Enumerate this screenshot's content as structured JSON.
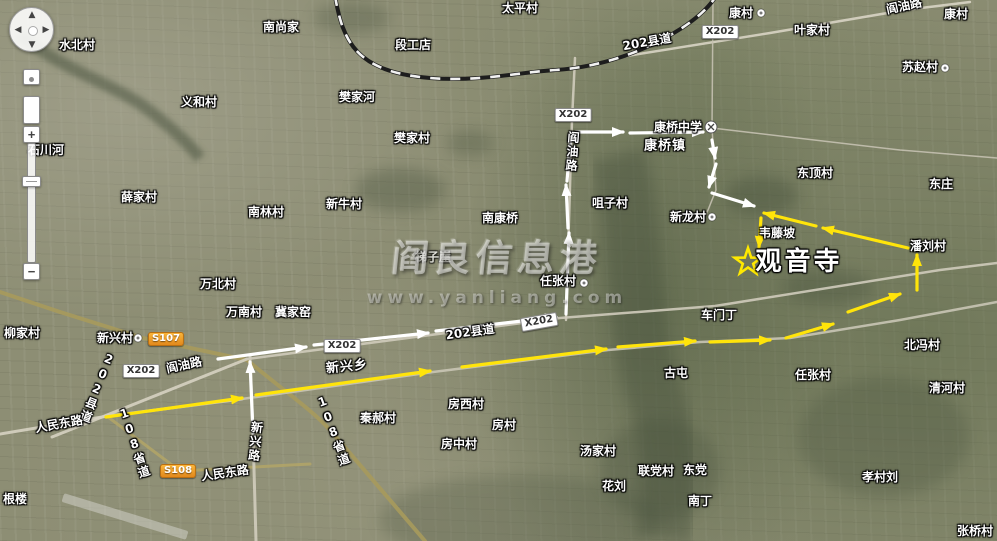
{
  "map": {
    "watermark": {
      "line1": "阎良信息港",
      "line2": "www.yanliang.com"
    },
    "destination": {
      "name": "观音寺",
      "star_x": 748,
      "star_y": 262
    },
    "colors": {
      "route_yellow": "#ffe40a",
      "route_white": "#ffffff",
      "star": "#ffe900",
      "shield": "#f2a124",
      "road_tan": "#a79a5c",
      "road_gray": "#d4d0c0",
      "veg": "#44503a"
    },
    "labels": [
      {
        "t": "水北村",
        "x": 77,
        "y": 45,
        "ty": "v"
      },
      {
        "t": "南尚家",
        "x": 281,
        "y": 27,
        "ty": "v"
      },
      {
        "t": "太平村",
        "x": 520,
        "y": 8,
        "ty": "v"
      },
      {
        "t": "段工店",
        "x": 413,
        "y": 45,
        "ty": "v"
      },
      {
        "t": "康村",
        "x": 741,
        "y": 13,
        "ty": "v"
      },
      {
        "t": "阎油路",
        "x": 904,
        "y": 6,
        "ty": "r",
        "rot": -12
      },
      {
        "t": "康村",
        "x": 956,
        "y": 14,
        "ty": "v"
      },
      {
        "t": "叶家村",
        "x": 812,
        "y": 30,
        "ty": "v"
      },
      {
        "t": "X202",
        "x": 720,
        "y": 32,
        "ty": "b"
      },
      {
        "t": "202县道",
        "x": 647,
        "y": 42,
        "ty": "r",
        "rot": -10
      },
      {
        "t": "苏赵村",
        "x": 920,
        "y": 67,
        "ty": "v"
      },
      {
        "t": "义和村",
        "x": 199,
        "y": 102,
        "ty": "v"
      },
      {
        "t": "樊家河",
        "x": 357,
        "y": 97,
        "ty": "v"
      },
      {
        "t": "X202",
        "x": 573,
        "y": 115,
        "ty": "b"
      },
      {
        "t": "樊家村",
        "x": 412,
        "y": 138,
        "ty": "v"
      },
      {
        "t": "康桥中学",
        "x": 678,
        "y": 127,
        "ty": "v"
      },
      {
        "t": "康桥镇",
        "x": 665,
        "y": 146,
        "ty": "t"
      },
      {
        "t": "阎油路",
        "x": 572,
        "y": 152,
        "ty": "vert",
        "rot": 4
      },
      {
        "t": "东顶村",
        "x": 815,
        "y": 173,
        "ty": "v"
      },
      {
        "t": "东庄",
        "x": 941,
        "y": 184,
        "ty": "v"
      },
      {
        "t": "石川河",
        "x": 46,
        "y": 150,
        "ty": "v"
      },
      {
        "t": "薛家村",
        "x": 139,
        "y": 197,
        "ty": "v"
      },
      {
        "t": "南林村",
        "x": 266,
        "y": 212,
        "ty": "v"
      },
      {
        "t": "新牛村",
        "x": 344,
        "y": 204,
        "ty": "v"
      },
      {
        "t": "咀子村",
        "x": 610,
        "y": 203,
        "ty": "v"
      },
      {
        "t": "南康桥",
        "x": 500,
        "y": 218,
        "ty": "v"
      },
      {
        "t": "新龙村",
        "x": 688,
        "y": 217,
        "ty": "v"
      },
      {
        "t": "韦藤坡",
        "x": 777,
        "y": 233,
        "ty": "v"
      },
      {
        "t": "潘刘村",
        "x": 928,
        "y": 246,
        "ty": "v"
      },
      {
        "t": "梯子崖",
        "x": 433,
        "y": 257,
        "ty": "v",
        "faint": true
      },
      {
        "t": "任张村",
        "x": 558,
        "y": 281,
        "ty": "v"
      },
      {
        "t": "观音寺",
        "x": 799,
        "y": 262,
        "ty": "big"
      },
      {
        "t": "万北村",
        "x": 218,
        "y": 284,
        "ty": "v"
      },
      {
        "t": "万南村",
        "x": 244,
        "y": 312,
        "ty": "v"
      },
      {
        "t": "冀家窑",
        "x": 293,
        "y": 312,
        "ty": "v"
      },
      {
        "t": "车门丁",
        "x": 719,
        "y": 315,
        "ty": "v"
      },
      {
        "t": "柳家村",
        "x": 22,
        "y": 333,
        "ty": "v"
      },
      {
        "t": "新兴村",
        "x": 115,
        "y": 338,
        "ty": "v"
      },
      {
        "t": "S107",
        "x": 166,
        "y": 339,
        "ty": "s"
      },
      {
        "t": "阎油路",
        "x": 184,
        "y": 365,
        "ty": "r",
        "rot": -12
      },
      {
        "t": "X202",
        "x": 141,
        "y": 371,
        "ty": "b"
      },
      {
        "t": "202县道",
        "x": 97,
        "y": 388,
        "ty": "vert",
        "rot": 22
      },
      {
        "t": "新兴乡",
        "x": 347,
        "y": 367,
        "ty": "t",
        "rot": -6
      },
      {
        "t": "X202",
        "x": 342,
        "y": 346,
        "ty": "b"
      },
      {
        "t": "202县道",
        "x": 470,
        "y": 332,
        "ty": "r",
        "rot": -8
      },
      {
        "t": "X202",
        "x": 539,
        "y": 322,
        "ty": "b",
        "rot": -10
      },
      {
        "t": "北冯村",
        "x": 922,
        "y": 345,
        "ty": "v"
      },
      {
        "t": "任张村",
        "x": 813,
        "y": 375,
        "ty": "v"
      },
      {
        "t": "古屯",
        "x": 676,
        "y": 373,
        "ty": "v"
      },
      {
        "t": "清河村",
        "x": 947,
        "y": 388,
        "ty": "v"
      },
      {
        "t": "人民东路",
        "x": 59,
        "y": 424,
        "ty": "r",
        "rot": -10
      },
      {
        "t": "108省道",
        "x": 134,
        "y": 443,
        "ty": "vert",
        "rot": -18
      },
      {
        "t": "秦郝村",
        "x": 378,
        "y": 418,
        "ty": "v"
      },
      {
        "t": "房西村",
        "x": 466,
        "y": 404,
        "ty": "v"
      },
      {
        "t": "房村",
        "x": 504,
        "y": 425,
        "ty": "v"
      },
      {
        "t": "房中村",
        "x": 459,
        "y": 444,
        "ty": "v"
      },
      {
        "t": "汤家村",
        "x": 598,
        "y": 451,
        "ty": "v"
      },
      {
        "t": "108省道",
        "x": 333,
        "y": 431,
        "ty": "vert",
        "rot": -20
      },
      {
        "t": "新兴路",
        "x": 255,
        "y": 442,
        "ty": "vert",
        "rot": 6
      },
      {
        "t": "S108",
        "x": 178,
        "y": 471,
        "ty": "s"
      },
      {
        "t": "人民东路",
        "x": 225,
        "y": 473,
        "ty": "r",
        "rot": -8
      },
      {
        "t": "联党村",
        "x": 656,
        "y": 471,
        "ty": "v"
      },
      {
        "t": "东党",
        "x": 695,
        "y": 470,
        "ty": "v"
      },
      {
        "t": "花刘",
        "x": 614,
        "y": 486,
        "ty": "v"
      },
      {
        "t": "南丁",
        "x": 700,
        "y": 501,
        "ty": "v"
      },
      {
        "t": "孝村刘",
        "x": 880,
        "y": 477,
        "ty": "v"
      },
      {
        "t": "根楼",
        "x": 15,
        "y": 499,
        "ty": "v"
      },
      {
        "t": "张桥村",
        "x": 975,
        "y": 531,
        "ty": "v"
      }
    ],
    "poi_dots": [
      {
        "x": 761,
        "y": 13
      },
      {
        "x": 945,
        "y": 68
      },
      {
        "x": 712,
        "y": 217
      },
      {
        "x": 584,
        "y": 283
      },
      {
        "x": 138,
        "y": 338
      }
    ],
    "school_icon": {
      "x": 711,
      "y": 127
    },
    "routes": {
      "white": [
        [
          253,
          433,
          250,
          362
        ],
        [
          218,
          359,
          306,
          347
        ],
        [
          314,
          345,
          428,
          333
        ],
        [
          436,
          331,
          556,
          317
        ],
        [
          566,
          314,
          569,
          233
        ],
        [
          568,
          228,
          566,
          185
        ],
        [
          567,
          181,
          571,
          134,
          0
        ],
        [
          576,
          132,
          623,
          132
        ],
        [
          630,
          133,
          703,
          132
        ],
        [
          712,
          140,
          715,
          158
        ],
        [
          716,
          164,
          709,
          187
        ],
        [
          712,
          193,
          754,
          206
        ]
      ],
      "yellow": [
        [
          106,
          417,
          242,
          398
        ],
        [
          256,
          395,
          430,
          371
        ],
        [
          462,
          367,
          606,
          349
        ],
        [
          618,
          347,
          695,
          341
        ],
        [
          710,
          342,
          770,
          340
        ],
        [
          786,
          338,
          833,
          324
        ],
        [
          848,
          312,
          900,
          294
        ],
        [
          917,
          290,
          917,
          255
        ],
        [
          908,
          248,
          823,
          228
        ],
        [
          816,
          226,
          764,
          213
        ],
        [
          761,
          218,
          759,
          247
        ]
      ]
    },
    "railway": {
      "d": "M335,-4 C343,42 356,72 430,78 C480,82 520,72 556,70 C600,67 645,52 682,28 C700,16 710,6 716,-4"
    },
    "roads": [
      {
        "d": "M0,292 L60,312 L143,338 L247,360 C285,392 310,408 330,430 L425,541",
        "c": "#a79a5c",
        "w": 4
      },
      {
        "d": "M108,417 L180,471 L310,464",
        "c": "#b0a468",
        "w": 3
      },
      {
        "d": "M52,437 L247,359",
        "c": "#d6d2c2",
        "w": 3
      },
      {
        "d": "M247,359 L560,318 L715,306 L940,270 L997,263",
        "c": "#cfcbbb",
        "w": 2.5
      },
      {
        "d": "M0,434 L108,416 L242,399",
        "c": "#d6d2c2",
        "w": 3
      },
      {
        "d": "M242,399 L433,372 L608,350 L700,342 L790,338 L900,320 L997,302",
        "c": "#c9c5b5",
        "w": 2.5
      },
      {
        "d": "M250,356 L253,433 L256,541",
        "c": "#d0ccbc",
        "w": 3
      },
      {
        "d": "M566,320 L572,120 L575,58",
        "c": "#d0ccbc",
        "w": 2.5
      },
      {
        "d": "M620,57 L770,33 L905,10 L970,2",
        "c": "#d8d4c4",
        "w": 2.5
      },
      {
        "d": "M712,128 L900,150 L997,158",
        "c": "#c5c1b1",
        "w": 1.5
      },
      {
        "d": "M713,0 L712,128",
        "c": "#c5c1b1",
        "w": 1.5
      },
      {
        "d": "M712,128 L716,190 L706,215",
        "c": "#c5c1b1",
        "w": 1.5
      }
    ],
    "veg_bands": [
      {
        "d": "M618,155 C640,240 628,330 660,410 C672,460 668,500 664,541",
        "w": 55,
        "o": 0.4,
        "f": "bl"
      },
      {
        "d": "M20,35 C70,75 120,85 155,115 C180,135 192,148 200,158",
        "w": 12,
        "o": 0.5,
        "f": "bl2"
      }
    ],
    "veg_blobs": [
      {
        "cx": 400,
        "cy": 190,
        "rx": 45,
        "ry": 22,
        "o": 0.35
      },
      {
        "cx": 470,
        "cy": 143,
        "rx": 24,
        "ry": 13,
        "o": 0.3
      },
      {
        "cx": 762,
        "cy": 196,
        "rx": 36,
        "ry": 20,
        "o": 0.4
      },
      {
        "cx": 828,
        "cy": 287,
        "rx": 46,
        "ry": 18,
        "o": 0.35
      },
      {
        "cx": 884,
        "cy": 437,
        "rx": 85,
        "ry": 60,
        "o": 0.28
      },
      {
        "cx": 520,
        "cy": 520,
        "rx": 140,
        "ry": 45,
        "o": 0.25
      },
      {
        "cx": 660,
        "cy": 470,
        "rx": 60,
        "ry": 50,
        "o": 0.3
      },
      {
        "cx": 352,
        "cy": 18,
        "rx": 38,
        "ry": 16,
        "o": 0.3
      }
    ],
    "runway": {
      "x": 60,
      "y": 512,
      "w": 130,
      "h": 9,
      "rot": 17
    }
  },
  "controls": {
    "zoom_in": "+",
    "zoom_out": "−",
    "pan": {
      "up": "▲",
      "down": "▼",
      "left": "◀",
      "right": "▶"
    }
  }
}
